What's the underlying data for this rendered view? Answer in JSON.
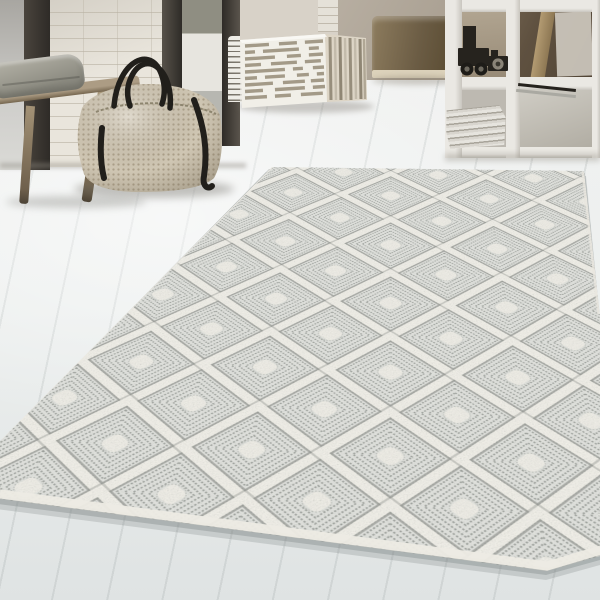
{
  "scene": {
    "alt": "Bright interior with a cream diamond-lattice textured rug on a whitewashed wood floor; wooden bench with grey cushion, woven beige duffel bag with black straps, striped cube pouf, olive cube and a white open cube shelf holding a black toy truck and stacked newspapers.",
    "objects": [
      {
        "name": "area-rug",
        "description": "cream high-pile rug with raised diamond lattice and stippled grey concentric diamond cells"
      },
      {
        "name": "wooden-bench",
        "description": "light wood bench with splayed legs"
      },
      {
        "name": "grey-cushion",
        "description": "grey pillow lying on bench"
      },
      {
        "name": "woven-duffel-bag",
        "description": "beige woven bag with black leather straps"
      },
      {
        "name": "striped-pouf",
        "description": "white cube pouf with grey dashed stripes"
      },
      {
        "name": "olive-cube",
        "description": "olive-brown cube seat with cream base"
      },
      {
        "name": "shelf-unit",
        "description": "white open cube shelving with toy truck and newspapers"
      },
      {
        "name": "doorway",
        "description": "open glass door showing exterior"
      }
    ]
  },
  "palette": {
    "floor_light": "#f1f2f1",
    "floor_mid": "#e9ecec",
    "floor_dark": "#dfe3e3",
    "rug_cream": "#f2f0e9",
    "rug_base": "#e2e3df",
    "rug_line": "#90948f",
    "rug_blob": "#f0eee7",
    "wall_brick": "#e9e5dc",
    "frame_dark": "#4a443d",
    "frame_darker": "#2e2b27",
    "glass_grey": "#b9b7b2",
    "exterior_wall": "#e7e5df",
    "foliage": "#8f8e82",
    "ground": "#b7b7b1",
    "bench_wood": "#ac9c84",
    "bench_dark": "#75664f",
    "cushion": "#8b8a80",
    "cushion_light": "#aeaca1",
    "bag_base": "#cfc6b3",
    "bag_dot": "#ab9f89",
    "strap_black": "#211f1b",
    "pouf_cream": "#f1efe8",
    "pouf_stripe": "#a39a88",
    "pouf_side": "#ddd5c6",
    "olive_light": "#8d7c5e",
    "olive_dark": "#57492f",
    "olive_base": "#dcd2bb",
    "shelf_white": "#eae8e3",
    "shelf_shade": "#c9c6bf",
    "backdrop_light": "#8a7a64",
    "backdrop_dark": "#4a3e30",
    "plank_tan": "#b39b72",
    "paper_light": "#e6e4de",
    "paper_dark": "#a8a49a",
    "object_black": "#26231e",
    "warm_grey": "#b7aea1"
  }
}
